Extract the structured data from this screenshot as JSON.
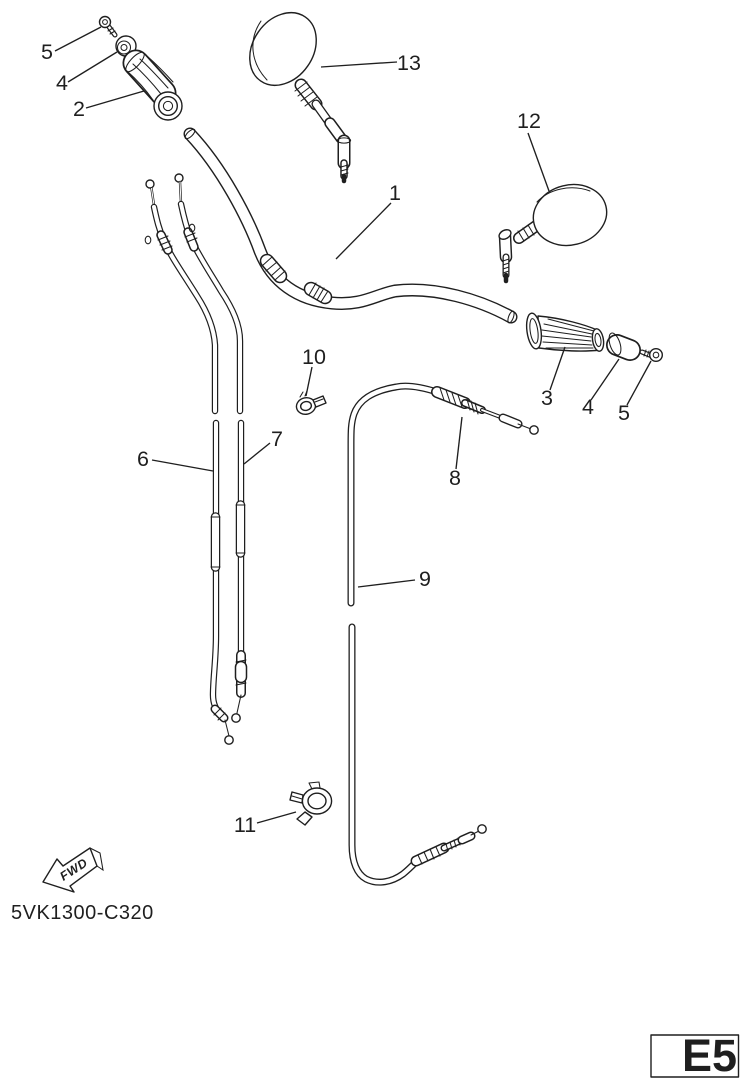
{
  "figure": {
    "background": "#ffffff",
    "line_color": "#1f1f1f",
    "part_code": "5VK1300-C320",
    "fwd_label": "FWD",
    "page_code": "E5",
    "callouts": [
      {
        "label": "5"
      },
      {
        "label": "4"
      },
      {
        "label": "2"
      },
      {
        "label": "13"
      },
      {
        "label": "1"
      },
      {
        "label": "12"
      },
      {
        "label": "3"
      },
      {
        "label": "4"
      },
      {
        "label": "5"
      },
      {
        "label": "10"
      },
      {
        "label": "6"
      },
      {
        "label": "7"
      },
      {
        "label": "8"
      },
      {
        "label": "9"
      },
      {
        "label": "11"
      }
    ]
  }
}
